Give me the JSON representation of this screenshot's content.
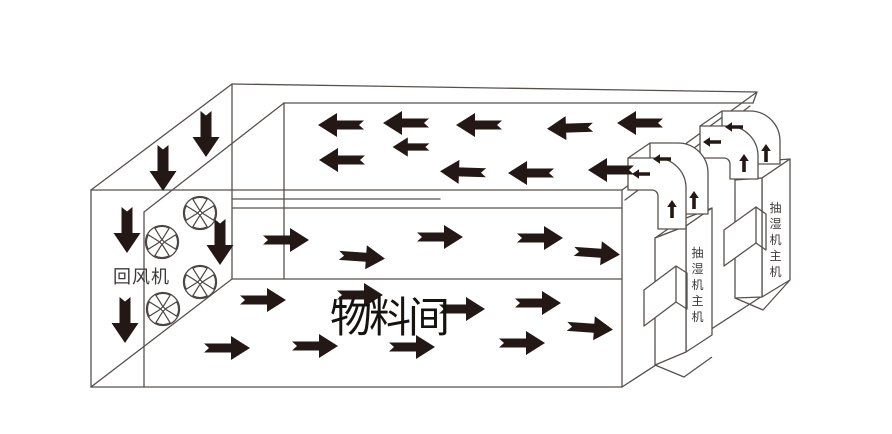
{
  "diagram": {
    "type": "dehumidification-airflow-schematic",
    "room": {
      "label": "物料间"
    },
    "return_fan": {
      "label": "回风机",
      "fan_count": 4
    },
    "dehumidifiers": [
      {
        "label": "抽湿机主机"
      },
      {
        "label": "抽湿机主机"
      }
    ],
    "airflow": {
      "ceiling_plenum_direction": "left",
      "ceiling_plenum_arrow_count": 10,
      "left_wall_direction": "down",
      "left_wall_arrow_count": 5,
      "room_middle_direction": "right",
      "room_middle_arrow_count": 5,
      "room_floor_direction": "right",
      "room_floor_arrow_count": 9,
      "duct_riser_direction": "up",
      "duct_outlet_direction": "left"
    },
    "colors": {
      "background": "#ffffff",
      "line": "#57514e",
      "arrow": "#231815",
      "label": "#3e3a39",
      "room_label": "#16120f"
    }
  }
}
